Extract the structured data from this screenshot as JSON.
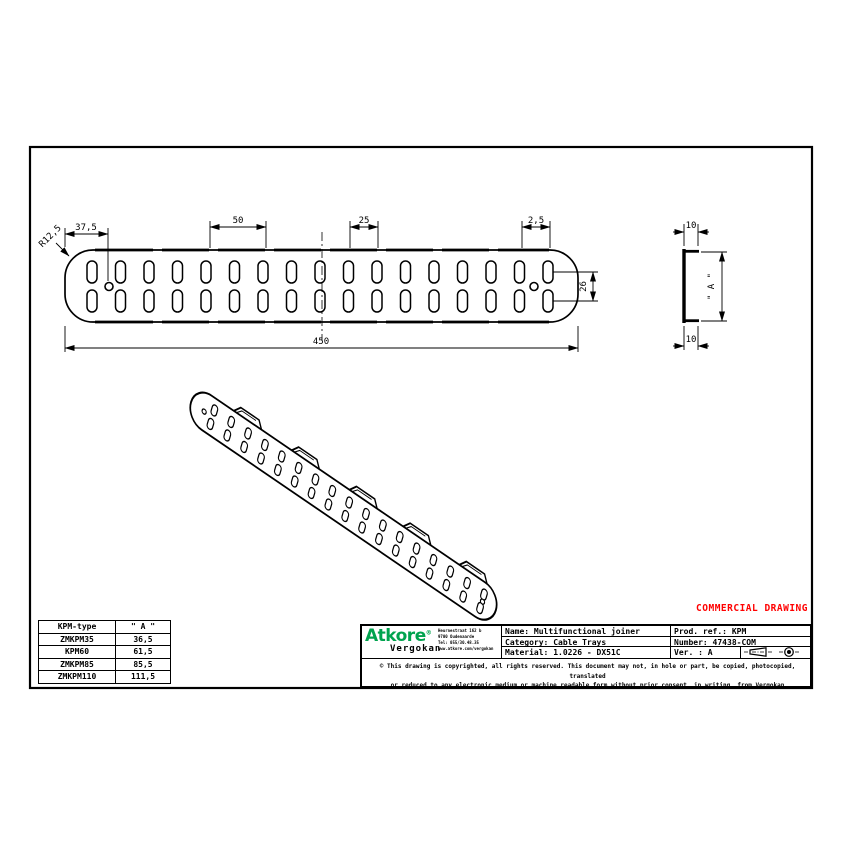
{
  "sheet": {
    "watermark": "COMMERCIAL DRAWING",
    "accent_red": "#ff0000",
    "brand_green": "#00a34e"
  },
  "top_view": {
    "dim_edge_to_hole": "37,5",
    "dim_end_radius": "R12,5",
    "dim_slot_pitch_double": "50",
    "dim_slot_pitch": "25",
    "dim_tab_offset": "2,5",
    "dim_total_length": "450",
    "dim_row_spacing": "26"
  },
  "side_view": {
    "dim_flange_top": "10",
    "dim_flange_bottom": "10",
    "dim_height": "\" A \""
  },
  "size_table": {
    "col_type": "KPM-type",
    "col_a": "\" A \"",
    "rows": [
      {
        "type": "ZMKPM35",
        "a": "36,5"
      },
      {
        "type": "KPM60",
        "a": "61,5"
      },
      {
        "type": "ZMKPM85",
        "a": "85,5"
      },
      {
        "type": "ZMKPM110",
        "a": "111,5"
      }
    ]
  },
  "title_block": {
    "brand": {
      "name": "Atkore",
      "reg": "®",
      "division": "Vergokan",
      "address_lines": [
        "Heurnestraat 162 b",
        "9700 Oudenaarde",
        "Tel: 055/30.48.35",
        "www.atkore.com/vergokan"
      ]
    },
    "name_label": "Name:",
    "name_value": "Multifunctional joiner",
    "category_label": "Category:",
    "category_value": "Cable Trays",
    "material_label": "Material:",
    "material_value": "1.0226 - DX51C",
    "prod_ref_label": "Prod. ref.:",
    "prod_ref_value": "KPM",
    "number_label": "Number:",
    "number_value": "47438-COM",
    "version_label": "Ver. :",
    "version_value": "A",
    "copyright_line1": "© This drawing is copyrighted, all rights reserved. This document may not, in hole or part, be copied, photocopied, translated",
    "copyright_line2": "or reduced to any electronic medium or machine readable form without prior consent, in writing, from Vergokan"
  }
}
